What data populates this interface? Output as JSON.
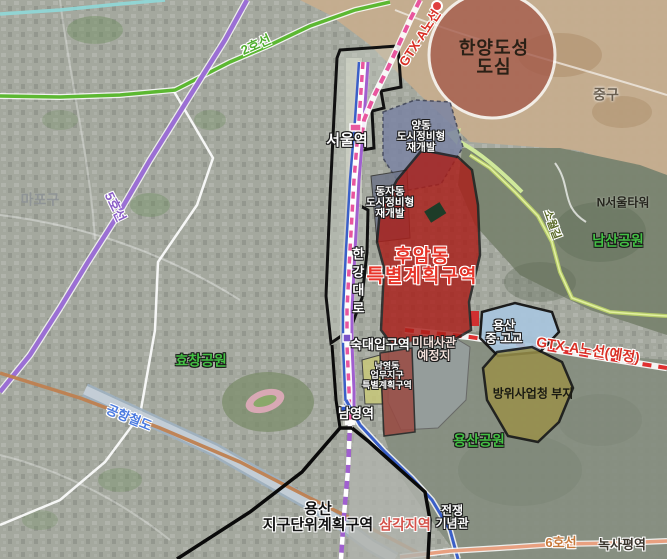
{
  "labels": {
    "line2": {
      "text": "2호선",
      "color": "#4fae2e"
    },
    "line5": {
      "text": "5호선",
      "color": "#8b5fc7"
    },
    "line6": {
      "text": "6호선",
      "color": "#c87a3c"
    },
    "airport_rail": {
      "text": "공항철도",
      "color": "#4a7ae0"
    },
    "gtx_north": {
      "text": "GTX-A노선",
      "color": "#d93025"
    },
    "gtx_planned": {
      "text": "GTX-A노선(예정)",
      "color": "#d93025"
    },
    "sowol_road": {
      "text": "소월길",
      "color": "#5a6a28"
    },
    "hangang_daero": {
      "text": "한강대로",
      "color": "#ffffff"
    },
    "seoul_station": {
      "text": "서울역",
      "color": "#ffffff"
    },
    "sukdae_station": {
      "text": "숙대입구역",
      "color": "#ffffff"
    },
    "namyeong_station": {
      "text": "남영역",
      "color": "#ffffff"
    },
    "samgakji_station": {
      "text": "삼각지역",
      "color": "#d4524a"
    },
    "noksapyeong_station": {
      "text": "녹사평역",
      "color": "#3a342c"
    },
    "n_seoul_tower": {
      "text": "N서울타워",
      "color": "#26261e"
    },
    "jung_gu": {
      "text": "중구",
      "color": "#6a5f50"
    },
    "mapo_gu": {
      "text": "마포구",
      "color": "#8f9496"
    },
    "hyochang_park": {
      "text": "효창공원",
      "color": "#44c044"
    },
    "namsan_park": {
      "text": "남산공원",
      "color": "#44c044"
    },
    "yongsan_park": {
      "text": "용산공원",
      "color": "#44c044"
    },
    "hanyang_core": {
      "line1": "한양도성",
      "line2": "도심",
      "color": "#2a2016"
    },
    "yangdong": {
      "line1": "양동",
      "line2": "도시정비형",
      "line3": "재개발",
      "color": "#ffffff"
    },
    "dongja": {
      "line1": "동자동",
      "line2": "도시정비형",
      "line3": "재개발",
      "color": "#ffffff"
    },
    "huam": {
      "line1": "후암동",
      "line2": "특별계획구역",
      "color": "#e8352a"
    },
    "us_embassy": {
      "line1": "미대사관",
      "line2": "예정지",
      "color": "#f2e0da"
    },
    "yongsan_school": {
      "line1": "용산",
      "line2": "중·고교",
      "color": "#ffffff"
    },
    "defense_agency": {
      "text": "방위사업청 부지",
      "color": "#1a1a12"
    },
    "namyeong_biz": {
      "line1": "남영동",
      "line2": "업무지구",
      "line3": "특별계획구역",
      "color": "#ffffff"
    },
    "yongsan_district": {
      "line1": "용산",
      "line2": "지구단위계획구역",
      "color": "#111111"
    },
    "war_memorial": {
      "line1": "전쟁",
      "line2": "기념관",
      "color": "#ffffff"
    }
  },
  "zone_colors": {
    "old_town_circle": "#a45a4a",
    "jung_gu_tan": "#c6ad8e",
    "namsan_green": "#79836f",
    "yongsan_park_green": "#848d7f",
    "yangdong_zone": "#7b84a3",
    "dongja_zone": "#6e7588",
    "huam_red": "#aa1f1a",
    "embassy_gray": "#979f9e",
    "school_blue": "#a9c6de",
    "defense_olive": "#99904a",
    "namyeong_yellow": "#c8c87a",
    "namyeong_red": "#9a4a42",
    "samgakji_gray": "#b0b3ad",
    "seoul_station_area": "#c9cec2"
  },
  "line_colors": {
    "line2": "#5cb832",
    "line5": "#9b6fd4",
    "line1_blue": "#3a5fc8",
    "line4_purple": "#a05fd0",
    "gtx_magenta": "#e8559e",
    "gtx_planned_red": "#e03030",
    "airport_band": "#9fb0c0",
    "gyeongui_orange": "#bf7f50",
    "line6_salmon": "#e8a080",
    "sowol_green": "#b6cc6a",
    "cyan_stream": "#8fd8d8",
    "boundary_black": "#0a0a0a"
  }
}
